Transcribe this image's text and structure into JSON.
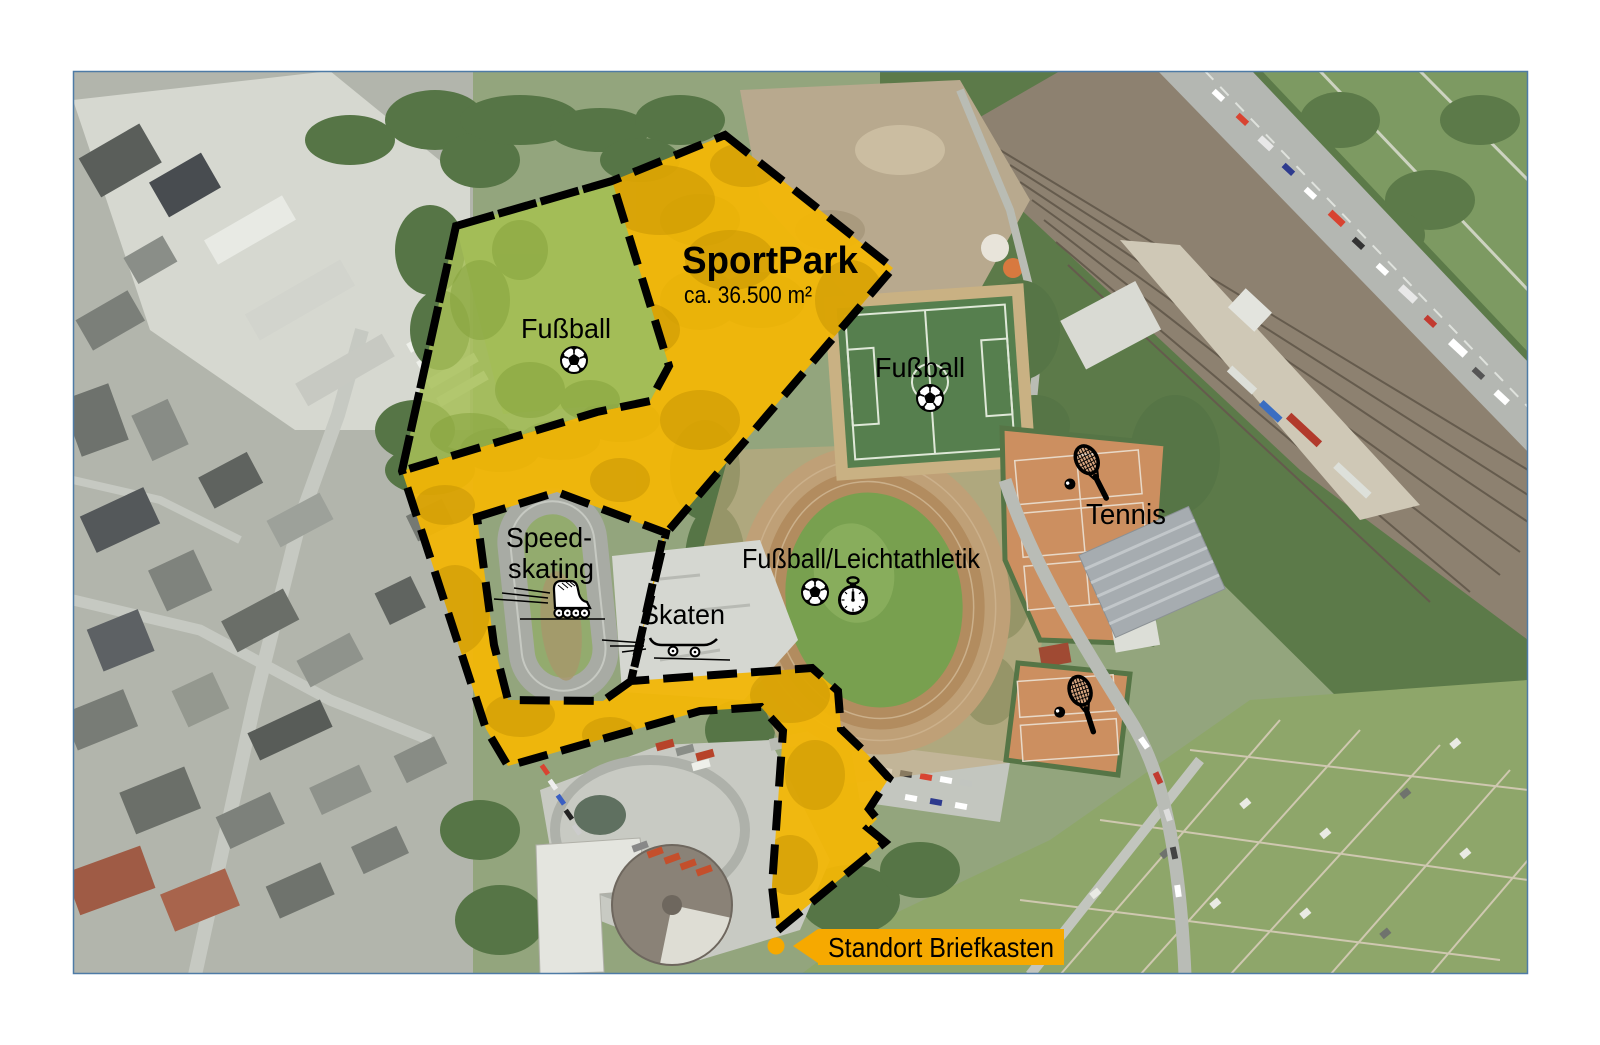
{
  "map": {
    "title": "SportPark",
    "area_label": "ca. 36.500 m²",
    "labels": {
      "fussball_west": "Fußball",
      "fussball_east": "Fußball",
      "speedskating_line1": "Speed-",
      "speedskating_line2": "skating",
      "skaten": "Skaten",
      "fussball_leichtathletik": "Fußball/Leichtathletik",
      "tennis": "Tennis"
    },
    "callout": {
      "text": "Standort Briefkasten"
    },
    "colors": {
      "overlay_yellow": "#f2b606",
      "field_green_tint": "#a7c058",
      "boundary_black": "#000000",
      "callout_orange": "#f6a900",
      "marker_dot": "#f6a900",
      "frame_border": "#4e7ba6"
    },
    "icons": {
      "soccer_ball": "soccer-ball-icon",
      "stopwatch": "stopwatch-icon",
      "inline_skate": "inline-skate-icon",
      "skateboard": "skateboard-icon",
      "tennis_racket": "tennis-racket-icon",
      "marker": "marker-dot",
      "arrow": "arrow-left-icon"
    }
  }
}
